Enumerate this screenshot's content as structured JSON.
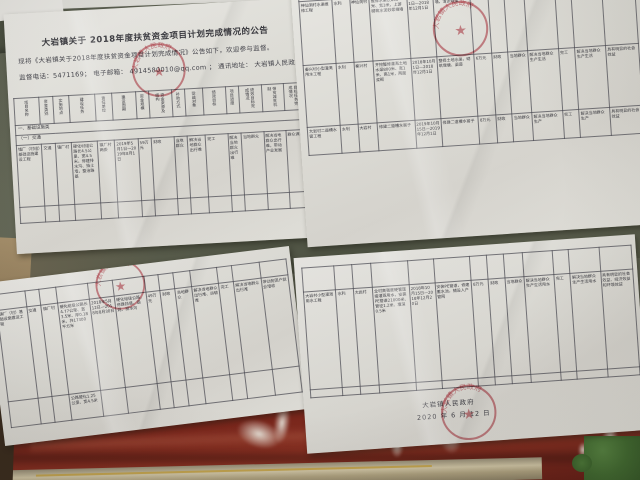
{
  "colors": {
    "seal_red": "#ba2c3a",
    "cloth_red": "#7d2418",
    "wall_green": "#565b49",
    "foliage_green": "#4a7434",
    "paper_white": "#e9e8e3"
  },
  "notice_top_left": {
    "title": "大岩镇关于 2018年度扶贫资金项目计划完成情况的公告",
    "intro_line": "现将《大岩镇关于2018年度扶贫资金项目计划完成情况》公告如下，欢迎参与监督。",
    "contact_line": "监督电话：5471169；  电子邮箱： 4914580010@qq.com ；  通讯地址： 大岩镇人民政府",
    "seal_text": "大岩镇人民政府",
    "table": {
      "headers": [
        "项目名称",
        "资金类别",
        "实施地点",
        "建设任务",
        "责任单位",
        "建设周期",
        "资金规模",
        "资金来源及结构",
        "补助方式",
        "受益对象",
        "绩效目标",
        "项目进度",
        "绩效目标完成情况",
        "带贫减贫机制",
        "目标任务完成情况"
      ],
      "group_rows": [
        "一、基础设施类",
        "（一）交通"
      ],
      "rows": [
        [
          "镇厂（村组）基础设施建设工程",
          "交通",
          "镇厂村",
          "硬化村组公路长4.5公里、宽4.5米，修建排水沟、挡土墙，整治路基",
          "镇厂村两委",
          "2019年5月1日—2019年8月1日",
          "59万元",
          "财政",
          "当地群众",
          "解决当地群众出行难",
          "完工",
          "解决当地群众出行难",
          "当地群众",
          "解决当地群众出行难，带动产业发展",
          "群众满意"
        ],
        [
          "",
          "",
          "",
          "",
          "",
          "",
          "",
          "",
          "",
          "",
          "",
          "",
          "",
          "",
          ""
        ]
      ]
    }
  },
  "notice_top_right": {
    "seal_text": "大岩镇人民政府",
    "table": {
      "rows": [
        [
          "神仙洞村水渠维修工程",
          "水利",
          "神仙洞村",
          "维修水渠长800米、宽3米，上游砌筑水泥砂浆挡墙",
          "2018年10月1日—2018年12月1日",
          "维修水渠，砌筑挡墙，清淤疏浚",
          "6万元",
          "财政",
          "当地群众",
          "解决当地群众生产生活用水",
          "完工",
          "解决当地群众生产生活用水",
          "具有明显的社会效益"
        ],
        [
          "秦兴村小型灌溉用水工程",
          "水利",
          "秦兴村",
          "开挖整修灌溉土地水渠800米、宽1米、高1米，两面浆砌",
          "2018年10月1日—2018年12月1日",
          "整修土地水渠，砌筑堰塘、渠道",
          "6万元",
          "财政",
          "当地群众",
          "解决当地群众生产生活",
          "完工",
          "解决当地群众生产生活",
          "具有明显的社会效益"
        ],
        [
          "大岩村二道槽水窖工程",
          "水利",
          "大岩村",
          "修建二道槽水窖子",
          "2019年10月15日—2019年12月1日",
          "修建二道槽水窖子",
          "8万元",
          "财政",
          "当地群众",
          "解决当地群众生产",
          "完工",
          "解决当地群众生产",
          "具有明显的社会效益"
        ]
      ]
    }
  },
  "notice_bottom_left": {
    "seal_text": "大岩镇人民政府",
    "table": {
      "rows": [
        [
          "镇厂（村）基础设施建设工程",
          "交通",
          "镇厂村",
          "硬化组级公路长4.77公里、宽3.5米、厚0.18米，共17300平方米",
          "2018年5月12日—2018年8月30日",
          "硬化组级公路，修建挡墙、涵洞、排水沟",
          "49万元",
          "财政",
          "当地群众",
          "解决当地群众出行难、运输难",
          "完工",
          "解决当地群众出行难",
          "带动贫困户就业增收"
        ],
        [
          "",
          "",
          "",
          "公路硬化1.25公里、宽4.5米",
          "",
          "",
          "",
          "",
          "",
          "",
          "",
          "",
          ""
        ]
      ]
    }
  },
  "notice_bottom_right": {
    "seal_text": "大岩镇人民政府",
    "signature": "大岩镇人民政府",
    "date": "2020 年 6 月 12 日",
    "table": {
      "rows": [
        [
          "大岩村小型灌溉用水工程",
          "水利",
          "大岩村",
          "全村高强度硬管连接灌溉用水，安装PE管道21000米、管径1.2米、埋深0.5米",
          "2018年10月15日—2018年12月20日",
          "安装PE管道，修建蓄水池，铺设入户管网",
          "8万元",
          "财政",
          "当地群众",
          "解决当地群众生产生活用水",
          "完工",
          "解决当地群众生产生活用水",
          "具有明显的社会效益、经济效益和环境效益"
        ]
      ]
    }
  }
}
